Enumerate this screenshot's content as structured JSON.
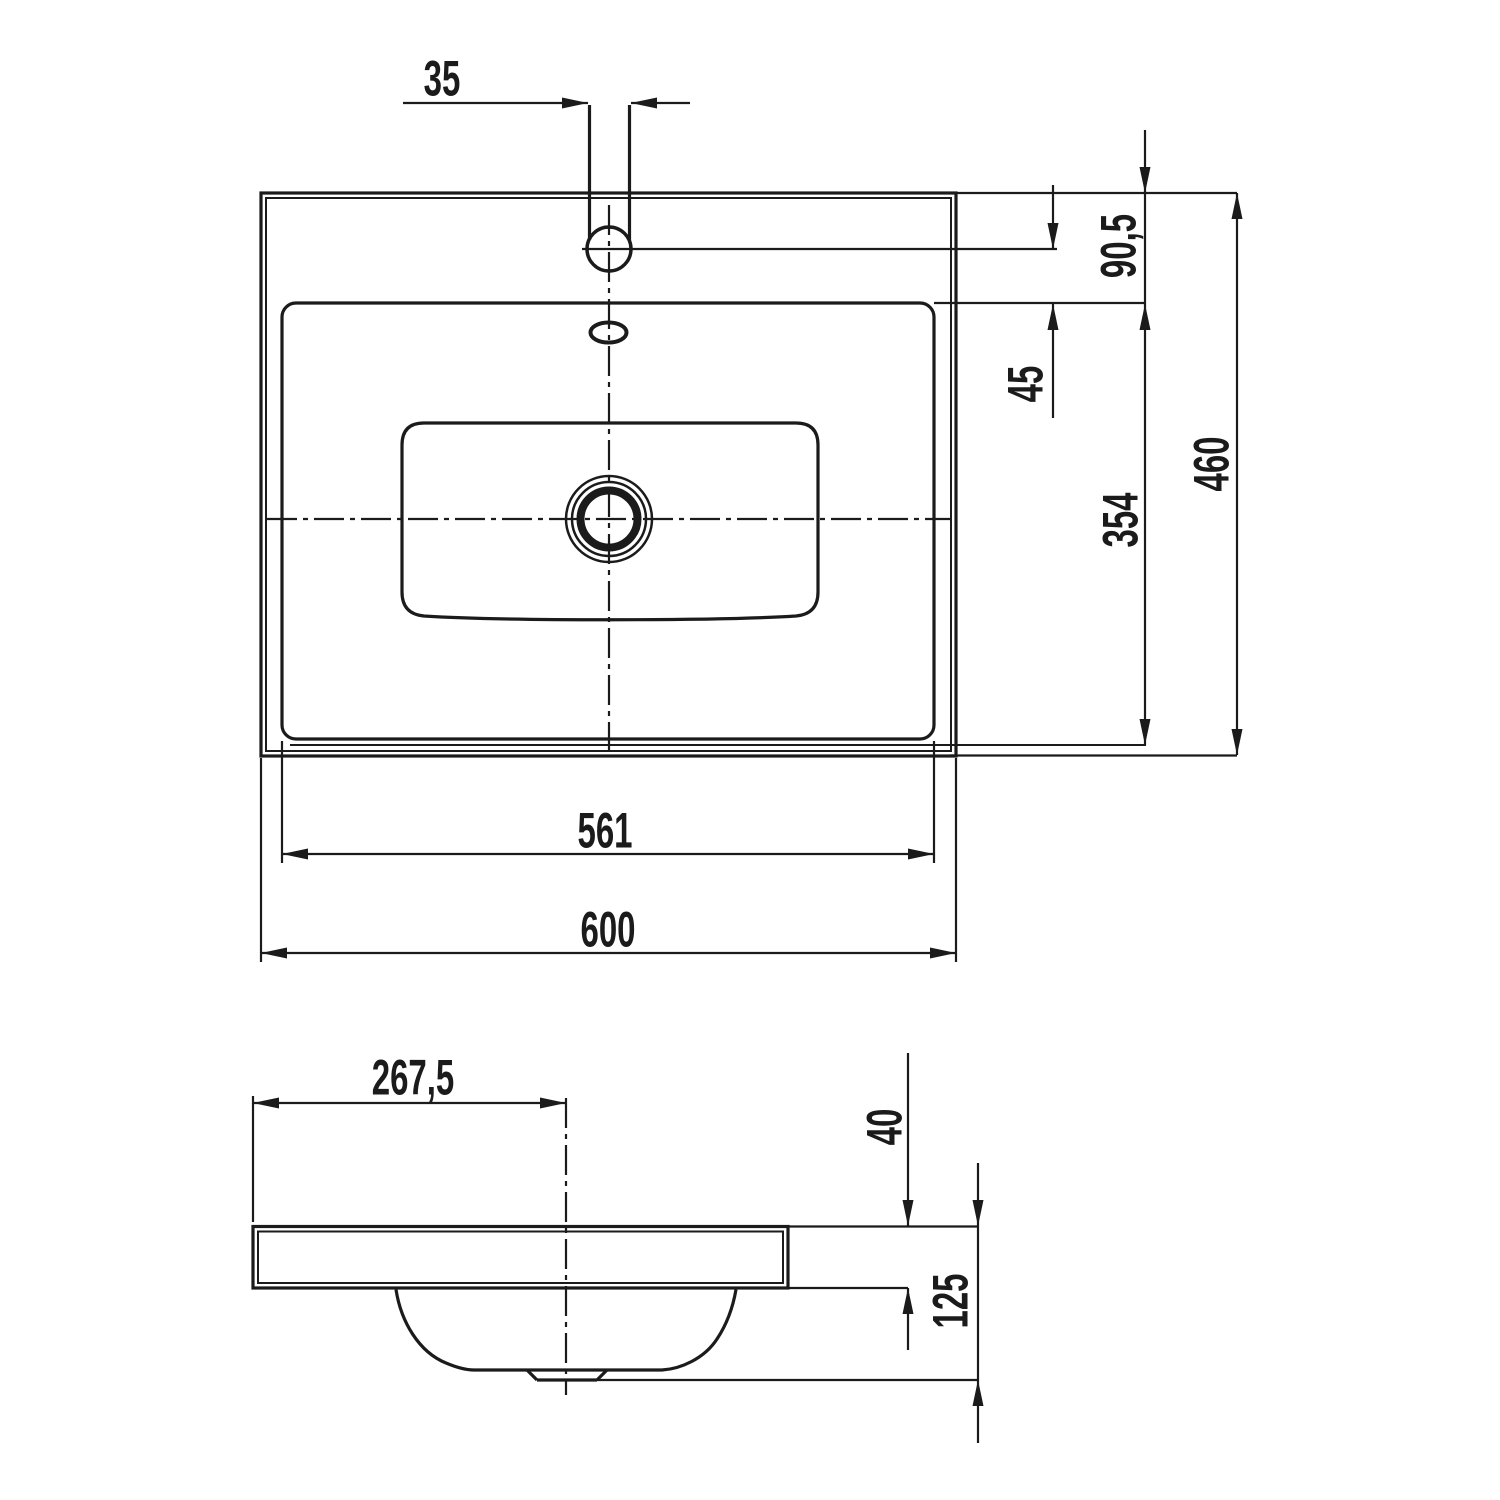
{
  "drawing": {
    "type": "technical-drawing",
    "subject": "washbasin two-view dimension drawing",
    "background_color": "#ffffff",
    "line_color": "#1b1b1b",
    "views": {
      "top_view": "plan view of washbasin",
      "side_view": "section / side view of washbasin"
    },
    "dims": {
      "faucet_hole": "35",
      "edge_to_basin": "90,5",
      "faucet_to_basin": "45",
      "basin_depth_len": "354",
      "overall_depth": "460",
      "basin_width": "561",
      "overall_width": "600",
      "drain_offset": "267,5",
      "rim_thickness": "40",
      "bowl_depth": "125"
    }
  }
}
